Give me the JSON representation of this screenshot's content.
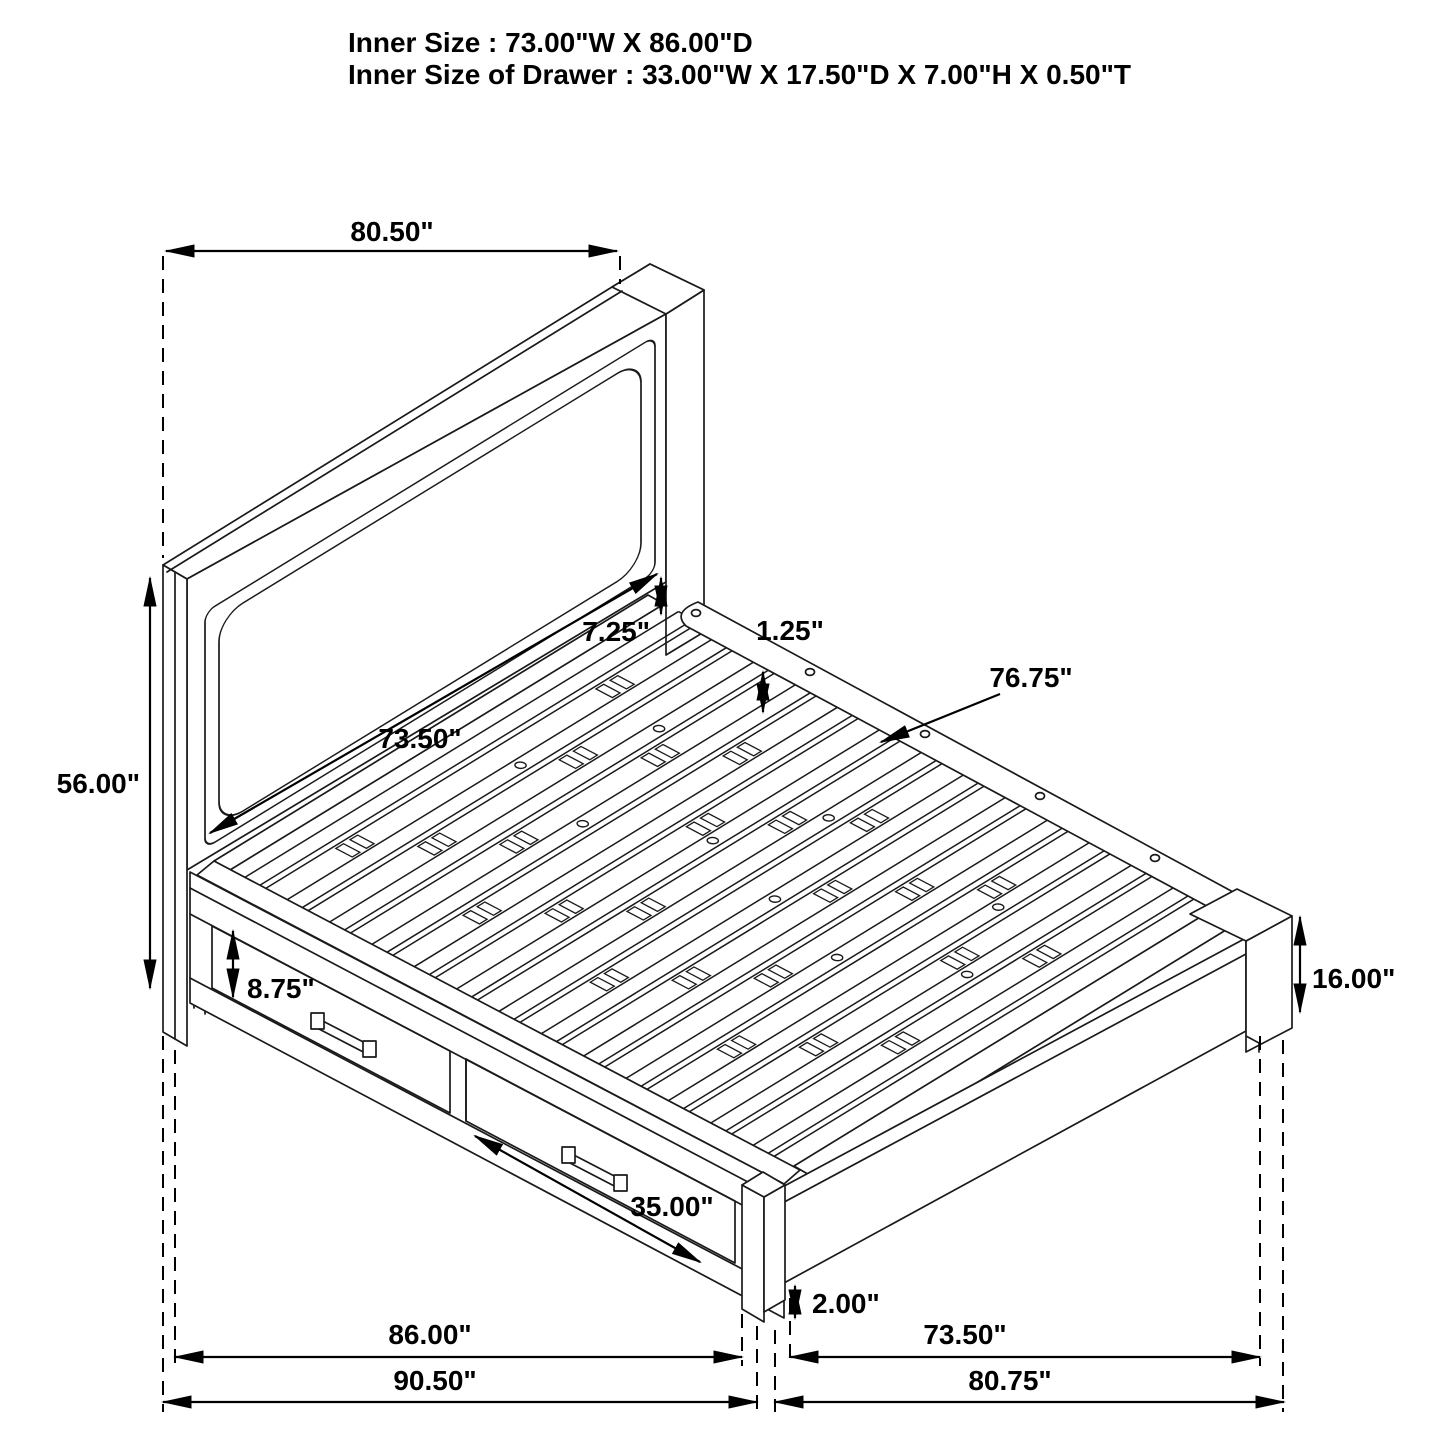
{
  "title": {
    "line1": "Inner Size : 73.00\"W X 86.00\"D",
    "line2": "Inner Size of Drawer : 33.00\"W X 17.50\"D X 7.00\"H X 0.50\"T"
  },
  "dimensions": {
    "headboard_width": "80.50\"",
    "headboard_height": "56.00\"",
    "headboard_inner_width": "73.50\"",
    "panel_to_rail_gap": "7.25\"",
    "slat_thickness": "1.25\"",
    "slat_length": "76.75\"",
    "drawer_front_height": "8.75\"",
    "drawer_width": "35.00\"",
    "footboard_height": "16.00\"",
    "floor_clearance": "2.00\"",
    "side_inner_length": "86.00\"",
    "side_outer_length": "90.50\"",
    "foot_inner_width": "73.50\"",
    "foot_outer_width": "80.75\""
  },
  "colors": {
    "line": "#1a1a1a",
    "dimension": "#000000",
    "background": "#ffffff"
  }
}
